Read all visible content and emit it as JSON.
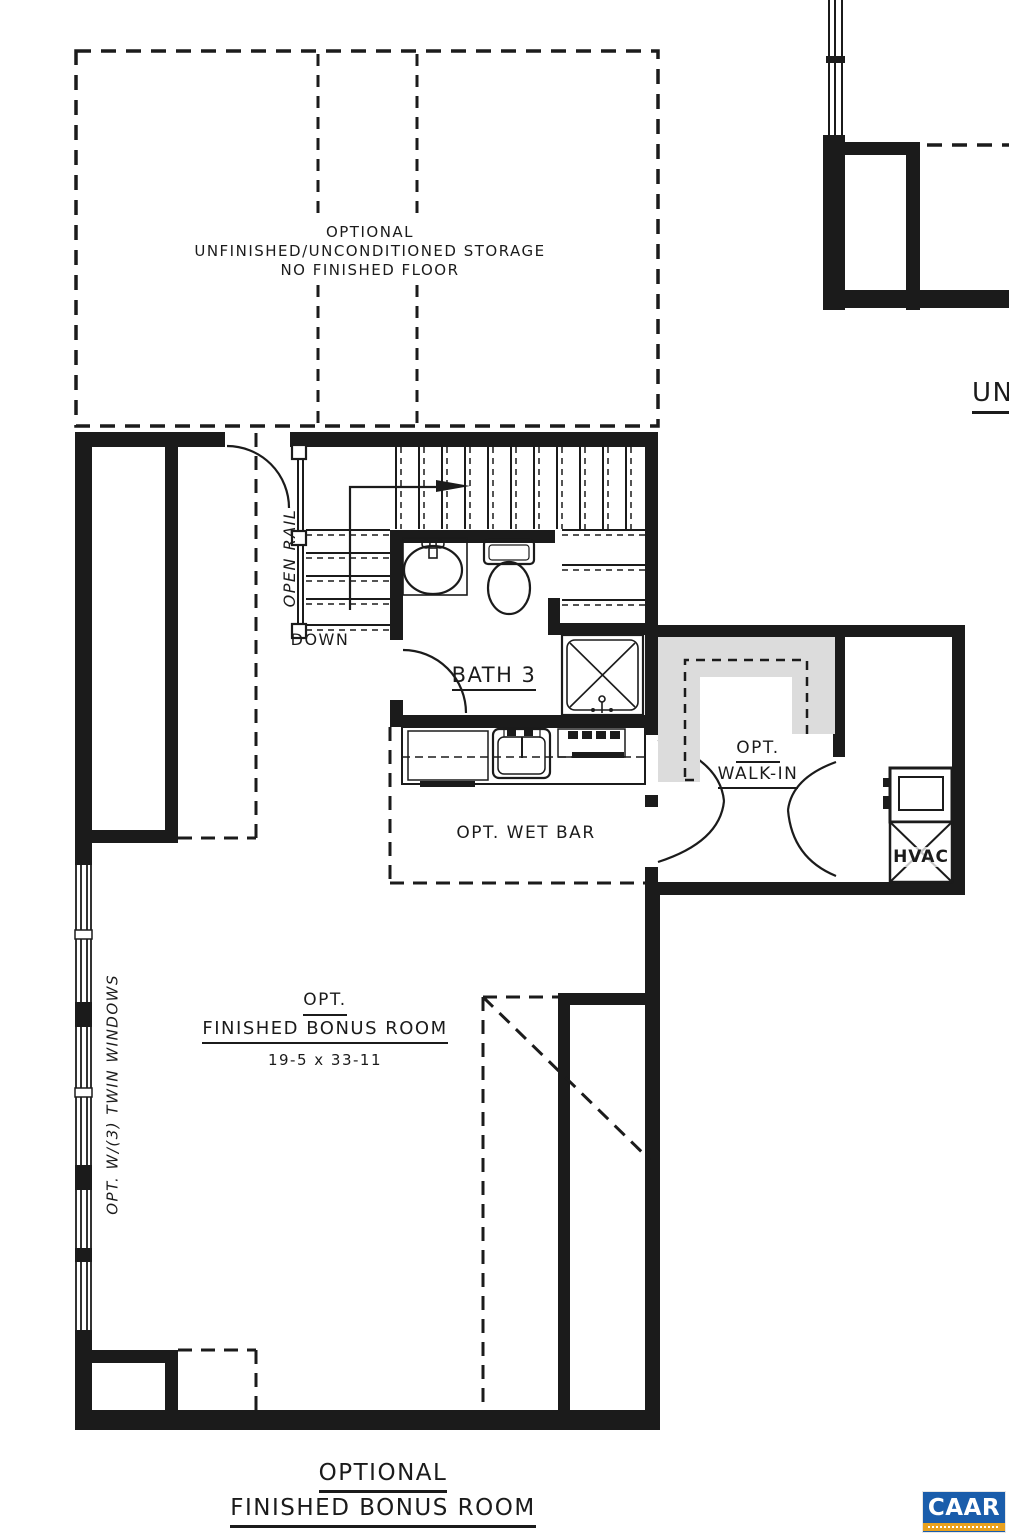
{
  "storage": {
    "l1": "OPTIONAL",
    "l2": "UNFINISHED/UNCONDITIONED STORAGE",
    "l3": "NO FINISHED FLOOR"
  },
  "stairs": {
    "open_rail": "OPEN RAIL",
    "down": "DOWN"
  },
  "bath": {
    "name": "BATH 3"
  },
  "walk_in": {
    "l1": "OPT.",
    "l2": "WALK-IN"
  },
  "wet_bar": {
    "label": "OPT. WET BAR"
  },
  "hvac": {
    "label": "HVAC"
  },
  "bonus_room": {
    "l1": "OPT.",
    "l2": "FINISHED BONUS ROOM",
    "dims": "19-5 x 33-11"
  },
  "windows": {
    "label": "OPT. W/(3) TWIN WINDOWS"
  },
  "adjacent_plan": {
    "partial_title": "UN"
  },
  "title": {
    "l1": "OPTIONAL",
    "l2": "FINISHED BONUS ROOM"
  },
  "logo": {
    "text": "CAAR"
  },
  "colors": {
    "line": "#1b1b1b",
    "shelf_gray": "#dcdcdc",
    "logo_blue": "#1a5dab",
    "logo_orange": "#e8a11e"
  }
}
